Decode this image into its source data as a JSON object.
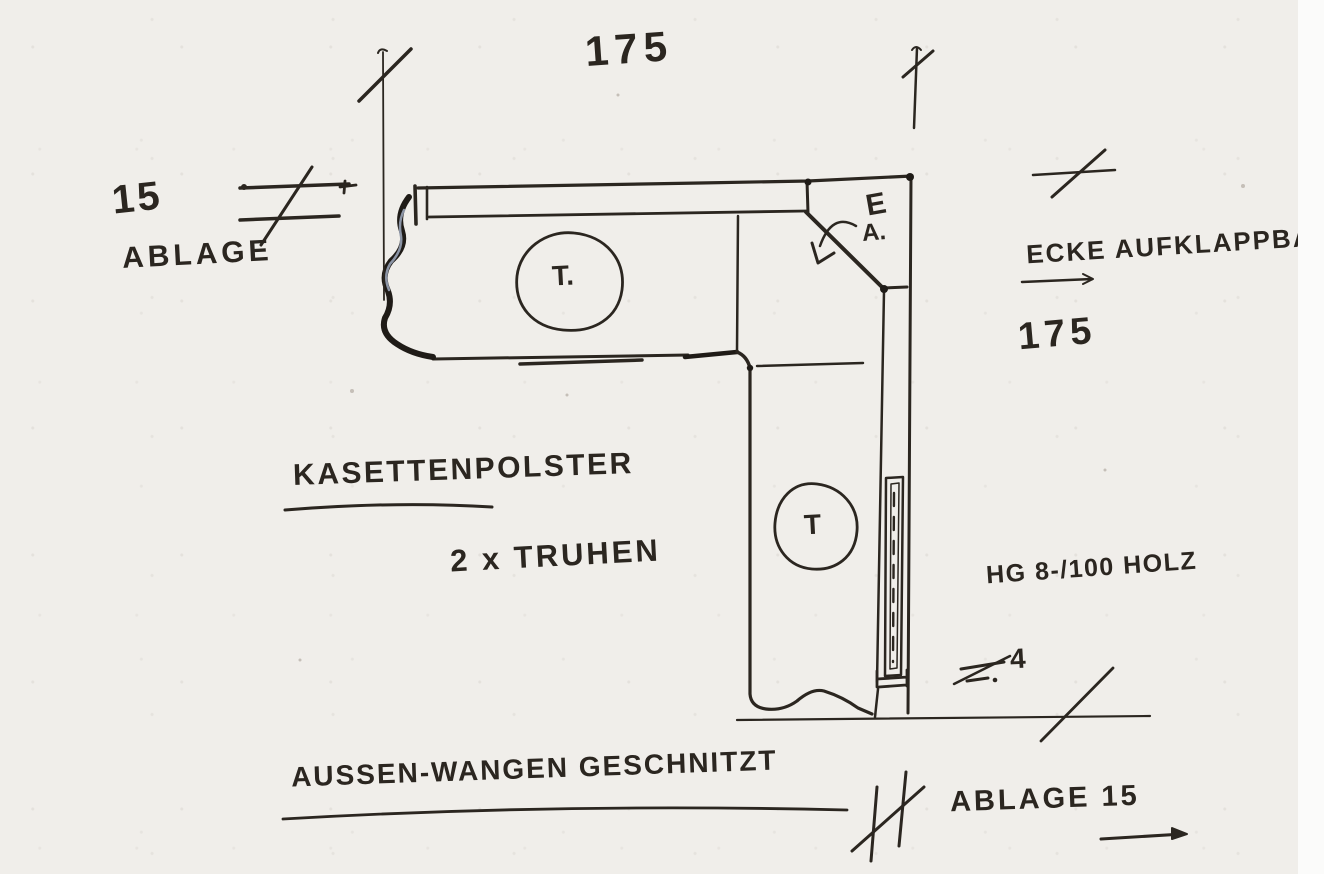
{
  "sketch": {
    "dimensions": {
      "top_width": "175",
      "shelf_depth": "15",
      "shelf_label": "ABLAGE",
      "right_height": "175",
      "panel_thickness": "4",
      "bottom_shelf": "ABLAGE 15"
    },
    "annotations": {
      "corner": "ECKE AUFKLAPPBAR",
      "corner_mark_e": "E",
      "corner_mark_a": "A.",
      "chest_top": "T.",
      "chest_right": "T",
      "cushion": "KASETTENPOLSTER",
      "chest_count": "2 x TRUHEN",
      "wood_spec": "HG 8-/100 HOLZ",
      "outer_panels": "AUSSEN-WANGEN GESCHNITZT"
    },
    "colors": {
      "paper": "#f0eeea",
      "ink": "#2b2620",
      "ink_heavy": "#1f1b17",
      "pencil": "#8b94a5"
    }
  }
}
